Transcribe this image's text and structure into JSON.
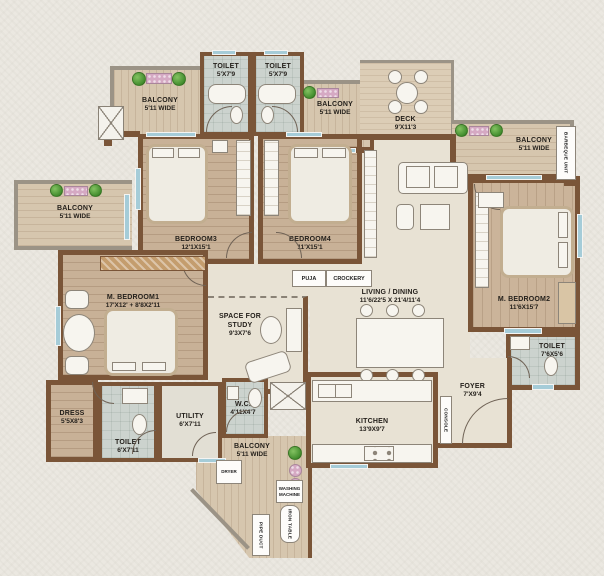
{
  "plan_title": "Apartment Floor Plan",
  "rooms": {
    "balcony_top_left": {
      "name": "BALCONY",
      "dims": "5'11 WIDE"
    },
    "toilet_top_1": {
      "name": "TOILET",
      "dims": "5'X7'9"
    },
    "toilet_top_2": {
      "name": "TOILET",
      "dims": "5'X7'9"
    },
    "balcony_top_mid": {
      "name": "BALCONY",
      "dims": "5'11 WIDE"
    },
    "deck": {
      "name": "DECK",
      "dims": "9'X11'3"
    },
    "balcony_right": {
      "name": "BALCONY",
      "dims": "5'11 WIDE"
    },
    "balcony_left": {
      "name": "BALCONY",
      "dims": "5'11 WIDE"
    },
    "bedroom3": {
      "name": "BEDROOM3",
      "dims": "12'1X15'1"
    },
    "bedroom4": {
      "name": "BEDROOM4",
      "dims": "11'X15'1"
    },
    "m_bedroom2": {
      "name": "M. BEDROOM2",
      "dims": "11'6X15'7"
    },
    "living_dining": {
      "name": "LIVING / DINING",
      "dims": "11'6/22'5 X 21'4/11'4"
    },
    "m_bedroom1": {
      "name": "M. BEDROOM1",
      "dims": "17'X12' + 8'8X2'11"
    },
    "study": {
      "name": "SPACE FOR STUDY",
      "dims": "9'3X7'6"
    },
    "dress": {
      "name": "DRESS",
      "dims": "5'5X8'3"
    },
    "toilet_bottom": {
      "name": "TOILET",
      "dims": "6'X7'11"
    },
    "utility": {
      "name": "UTILITY",
      "dims": "6'X7'11"
    },
    "wc": {
      "name": "W.C.",
      "dims": "4'11X4'7"
    },
    "balcony_bottom": {
      "name": "BALCONY",
      "dims": "5'11 WIDE"
    },
    "kitchen": {
      "name": "KITCHEN",
      "dims": "13'9X9'7"
    },
    "foyer": {
      "name": "FOYER",
      "dims": "7'X9'4"
    },
    "toilet_right": {
      "name": "TOILET",
      "dims": "7'6X5'6"
    }
  },
  "fixtures": {
    "puja": "PUJA",
    "crockery": "CROCKERY",
    "console": "CONSOLE",
    "dryer": "DRYER",
    "washing_machine": "WASHING MACHINE",
    "iron_table": "IRON TABLE",
    "barbeque_unit": "BARBEQUE UNIT",
    "pipe_duct": "PIPE DUCT"
  },
  "colors": {
    "wall": "#7a5538",
    "parapet": "#9b9386",
    "wood_floor": "#c8b197",
    "balcony_floor": "#d6c6ae",
    "tile_floor": "#ccd3ce",
    "living_floor": "#e8e2d4",
    "window": "#a5ccd8",
    "plant": "#3f8a2b",
    "flower": "#d5a9c3"
  }
}
